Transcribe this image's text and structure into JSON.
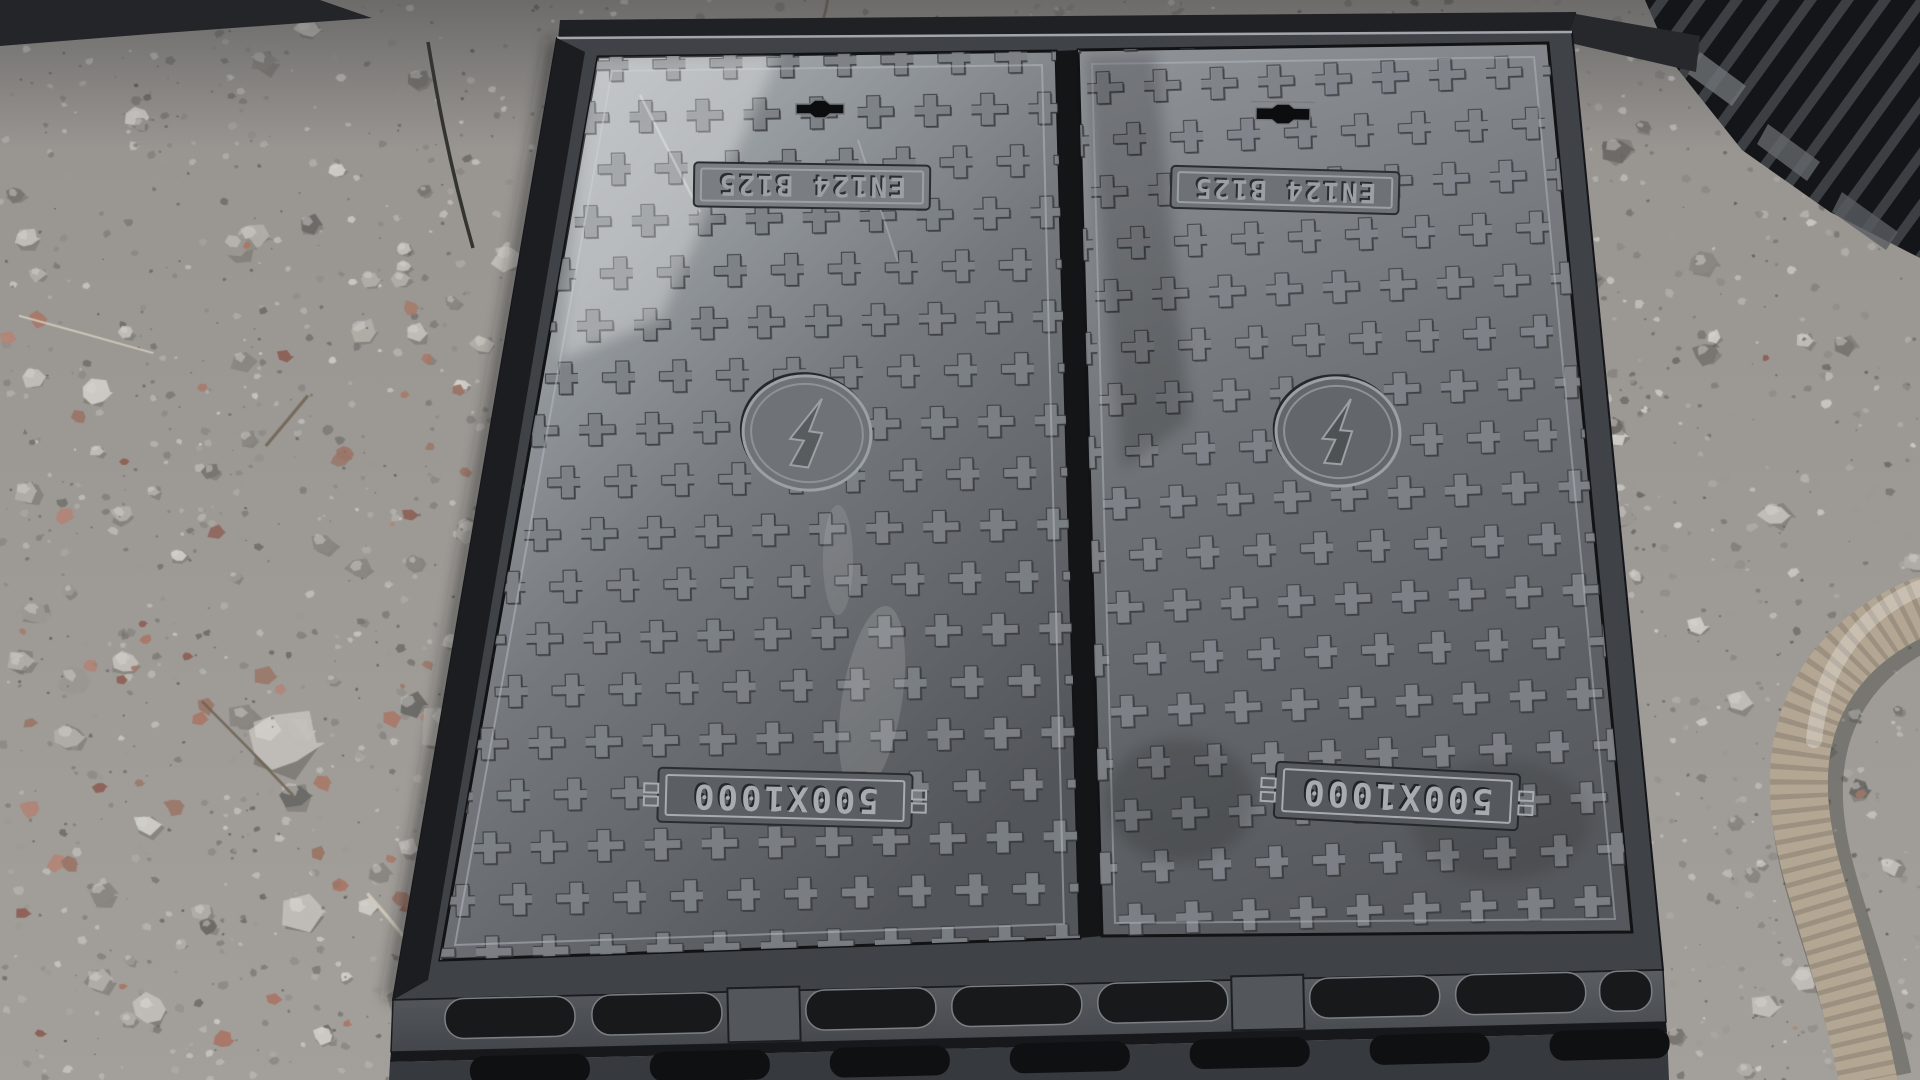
{
  "scene": {
    "unit": {
      "left_cover": {
        "top_plate": "EN124 B125",
        "size_plate": "500X1000"
      },
      "right_cover": {
        "top_plate": "EN124 B125",
        "size_plate": "500X1000"
      }
    },
    "colors": {
      "casting_dark": "#1b1d1f",
      "frame_top": "#3f4247",
      "frame_face_top": "#5a5e63",
      "frame_face_bottom": "#43464a",
      "frame_face_lower": "#36393d",
      "slot": "#17191b",
      "slot_lower": "#0f1012",
      "emboss": "#9aa0a5",
      "cover_left_light": "#b4b9bd",
      "cover_left_dark": "#525559",
      "cover_right_light": "#8d9196",
      "cover_right_dark": "#55585c",
      "cross_fill": "#84888d",
      "cross_edge": "#3a3d41",
      "hose": "#b3a794",
      "hose_rib": "#867c6c",
      "gravel_base": "#a3a09b",
      "gravel_palette": [
        "#c2bfba",
        "#b1aea9",
        "#9b9893",
        "#8a8783",
        "#787571",
        "#cfccc7",
        "#6b6966"
      ],
      "brick_palette": [
        "#a87868",
        "#b28476",
        "#8d6055",
        "#9a7668"
      ],
      "speck": "#5d5b57",
      "twig_light": "#d6cfbf",
      "twig_dark": "#6e6355"
    }
  }
}
